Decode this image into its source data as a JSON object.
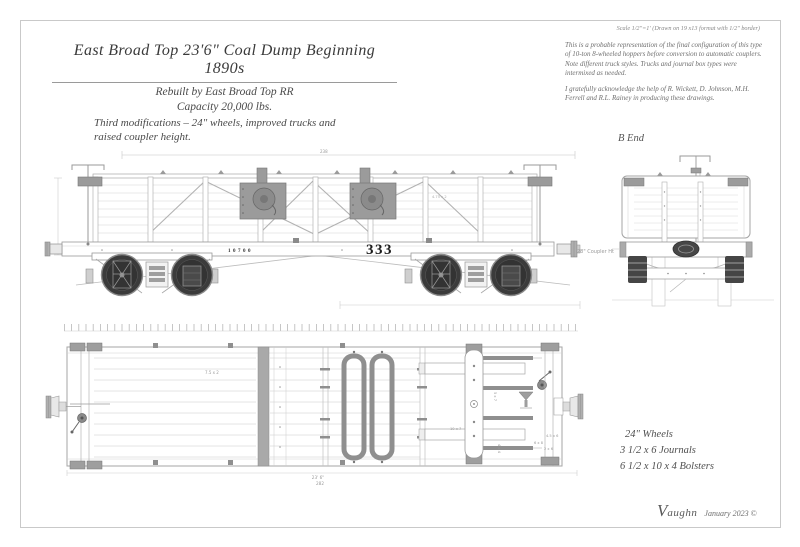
{
  "header": {
    "title": "East Broad Top 23'6\" Coal Dump Beginning 1890s",
    "subtitle1": "Rebuilt by East Broad Top RR",
    "subtitle2": "Capacity 20,000 lbs.",
    "modifications": "Third modifications – 24\" wheels, improved trucks and raised coupler height."
  },
  "notes": {
    "scale": "Scale 1/2\"=1' (Drawn on 19 x13 format with 1/2\" border)",
    "description": "This is a probable representation of the final configuration of this type of 10-ton 8-wheeled hoppers before conversion to automatic couplers. Note different truck styles. Trucks and journal box types were intermixed as needed.",
    "acknowledgement": "I gratefully acknowledge the help of R. Wickett, D. Johnson, M.H. Ferrell and R.L. Rainey in producing these drawings."
  },
  "side_view": {
    "top_dimension": "238",
    "board_dimension": "4.75 x 2",
    "car_number_small": "10700",
    "car_number_large": "333"
  },
  "end_view": {
    "label": "B End",
    "coupler_height": "28\" Coupler Ht"
  },
  "plan_view": {
    "board_dimension": "7.5 x 2",
    "length_feet": "23' 6\"",
    "length_inches": "282",
    "dims": {
      "d1": "5 x 7",
      "d2": "10 x 7",
      "d3": "4 x 4",
      "d4": "6 x 8",
      "d5": "4.5 x 6",
      "d6": "2 x 6"
    }
  },
  "specs": {
    "line1": "24\" Wheels",
    "line2": "3 1/2 x 6 Journals",
    "line3": "6 1/2 x 10 x 4 Bolsters"
  },
  "signature": {
    "initial": "V",
    "name_rest": "aughn",
    "date": "January 2023 ©"
  },
  "colors": {
    "drawing_line": "#b0b0b0",
    "hardware_gray": "#9b9b9b",
    "wheel_dark": "#3b3b3b",
    "text_gray": "#555555"
  }
}
